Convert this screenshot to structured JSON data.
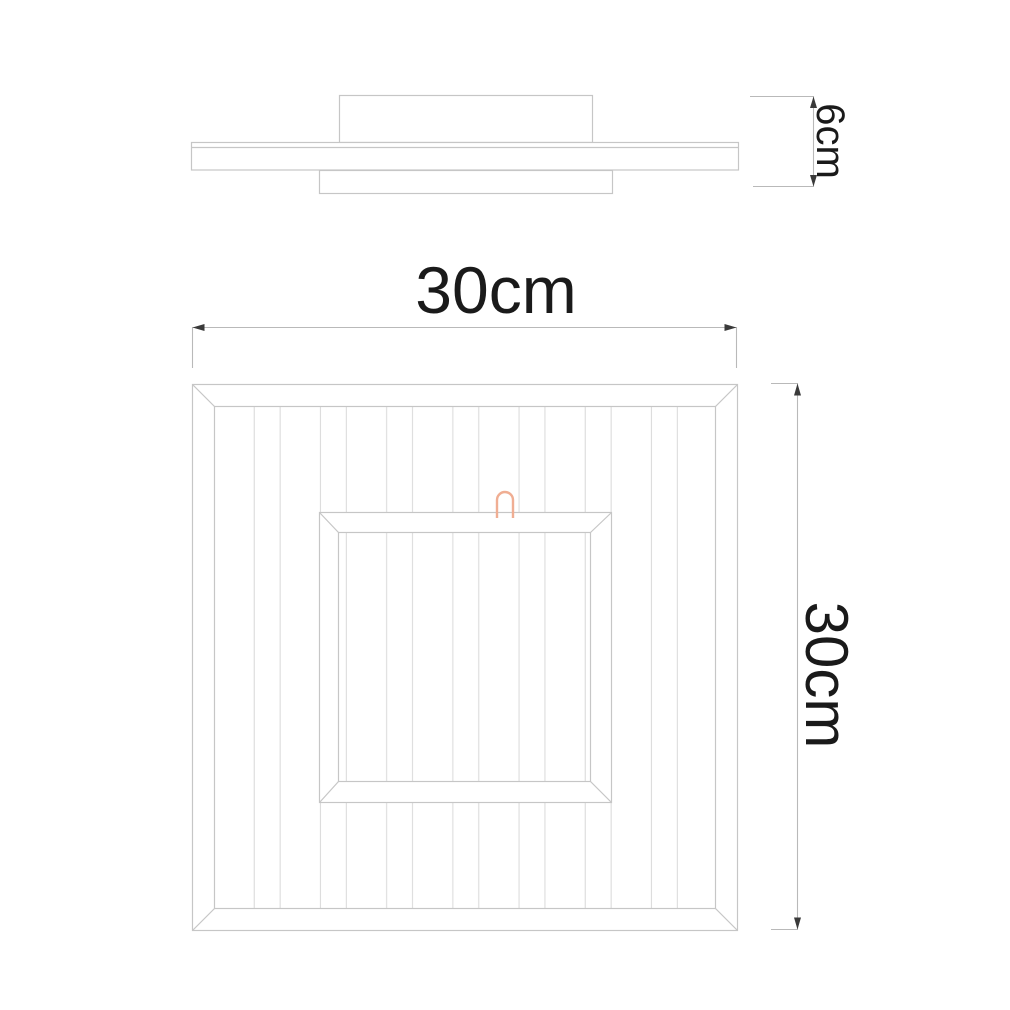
{
  "diagram": {
    "kind": "product-dimension-drawing",
    "views": {
      "side": {
        "depth": {
          "label": "6cm"
        }
      },
      "top": {
        "width": {
          "label": "30cm"
        },
        "height": {
          "label": "30cm"
        }
      }
    },
    "icons": {
      "power_cable": "inverted-u-hook"
    },
    "colors": {
      "outline": "#c6c6c6",
      "stripe": "#dcdcdc",
      "dimension_line": "#b9b9b9",
      "arrow": "#3a3a3a",
      "text": "#1a1a1a",
      "hook_accent": "#f0ae93",
      "background": "#ffffff"
    }
  }
}
